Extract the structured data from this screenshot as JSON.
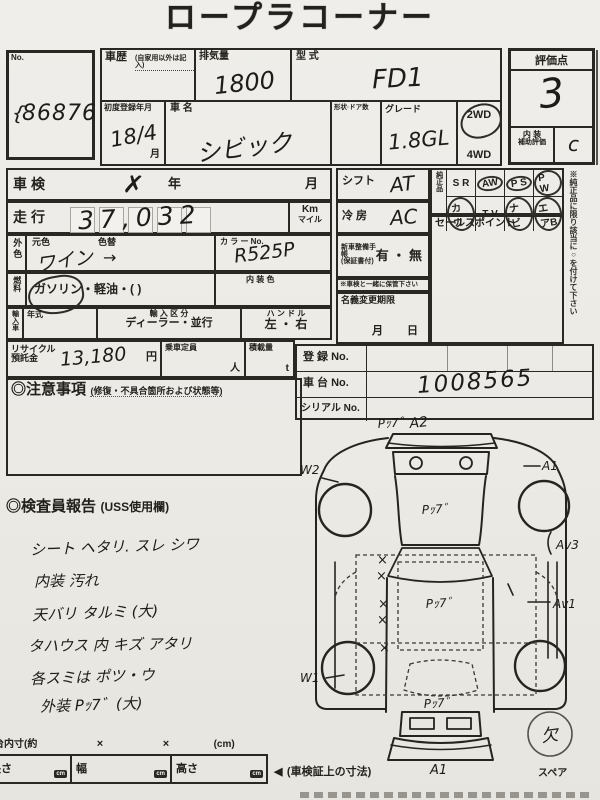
{
  "title": "ロープラコーナー",
  "colors": {
    "ink": "#23211c",
    "paper": "#eceae5",
    "pen": "#1d1c19"
  },
  "no_box": {
    "label": "No.",
    "mark": "{",
    "value": "86876"
  },
  "header": {
    "rireki_label": "車歴",
    "rireki_note": "(自家用以外は記入)",
    "haikiryo_label": "排気量",
    "haikiryo_value": "1800",
    "katashiki_label": "型 式",
    "katashiki_value": "FD1",
    "hyoka_label": "評価点",
    "hyoka_value": "3",
    "naiso_label1": "内 装",
    "naiso_label2": "補助評価",
    "naiso_value": "c",
    "shodo_label": "初度登録年月",
    "shodo_value": "18/4",
    "shodo_month": "月",
    "shamei_label": "車 名",
    "shamei_value": "シビック",
    "keijo_label": "形状·ドア数",
    "grade_label": "グレード",
    "grade_value": "1.8GL",
    "drive_2wd": "2WD",
    "drive_4wd": "4WD"
  },
  "left_form": {
    "shaken_label": "車検",
    "shaken_mark": "✗",
    "year_label": "年",
    "month_label": "月",
    "soko_label": "走行",
    "soko_value": "37,032",
    "km_label": "Km",
    "mile_label": "マイル",
    "gaishoku_label": "外色",
    "motoiro_label": "元色",
    "iroka_label": "色替",
    "color_value": "ワイン",
    "color_arrow": "→",
    "colorno_label": "カ ラ ー No.",
    "colorno_value": "R525P",
    "nenryo_label": "燃料",
    "nenryo_gasoline": "ガソリン",
    "nenryo_rest": "・軽油・(        )",
    "naisoshoku_label": "内 装 色",
    "import_label": "輸入車",
    "nenshiki_label": "年式",
    "kubun_label": "輸 入 区 分",
    "kubun_value": "ディーラー・並行",
    "handle_label": "ハ ン ド ル",
    "handle_value": "左 ・ 右",
    "recycle_label1": "リサイクル",
    "recycle_label2": "預託金",
    "recycle_value": "13,180",
    "yen_label": "円",
    "teiin_label": "乗車定員",
    "nin_label": "人",
    "sekisai_label": "積載量",
    "ton_label": "t"
  },
  "right_form": {
    "shift_label": "シフト",
    "shift_value": "AT",
    "reibo_label": "冷 房",
    "reibo_value": "AC",
    "seibi_label1": "新車整備手帳",
    "seibi_label2": "(保証書付)",
    "ari_nashi": "有 ・ 無",
    "hokan_note": "※車検と一緒に保管下さい",
    "meigi_label": "名義変更期限",
    "meigi_month": "月",
    "meigi_day": "日",
    "junsei_label": "純正品",
    "equipment": [
      {
        "label": "S R",
        "circled": false
      },
      {
        "label": "AW",
        "circled": true
      },
      {
        "label": "P S",
        "circled": true
      },
      {
        "label": "P W",
        "circled": true
      },
      {
        "label": "カワ",
        "circled": true
      },
      {
        "label": "T V",
        "circled": false
      },
      {
        "label": "ナビ",
        "circled": true
      },
      {
        "label": "エアB",
        "circled": true
      }
    ],
    "sales_label": "セールスポイント",
    "vertical_note": "※純正品に限り該当に○を付けて下さい",
    "toroku_label": "登 録 No.",
    "chassis_label": "車 台 No.",
    "chassis_value": "1008565",
    "serial_label": "シリアル No."
  },
  "chui": {
    "label": "◎注意事項",
    "note": "(修復・不具合箇所および状態等)"
  },
  "kensain": {
    "label": "◎検査員報告",
    "note": "(USS使用欄)",
    "notes": [
      "シート ヘタリ. スレ シワ",
      "内装 汚れ",
      "天バリ タルミ (大)",
      "タハウス 内 キズ アタリ",
      "各スミは ポツ・ウ",
      "外装 Pｯ7゛(大)"
    ]
  },
  "diagram": {
    "front_note": "Pｯ7゛",
    "front_grade": "A2",
    "left_front": "W2",
    "right_front": "A1",
    "hood_note": "Pｯ7゛",
    "right_mid": "Av3",
    "right_rear": "Av1",
    "left_rear": "W1",
    "roof_note": "Pｯ7゛",
    "trunk_note": "Pｯ7゛",
    "rear_bumper": "A1",
    "x_mark": "×",
    "spare_missing": "欠",
    "spare_label": "スペア"
  },
  "footer": {
    "nidai_label": "台内寸(約",
    "x1": "×",
    "x2": "×",
    "cm_paren": "(cm)",
    "nagasa_label": "長さ",
    "haba_label": "幅",
    "takasa_label": "高さ",
    "cm_badge": "cm",
    "arrow": "◀",
    "sunpo_note": "(車検証上の寸法)"
  }
}
